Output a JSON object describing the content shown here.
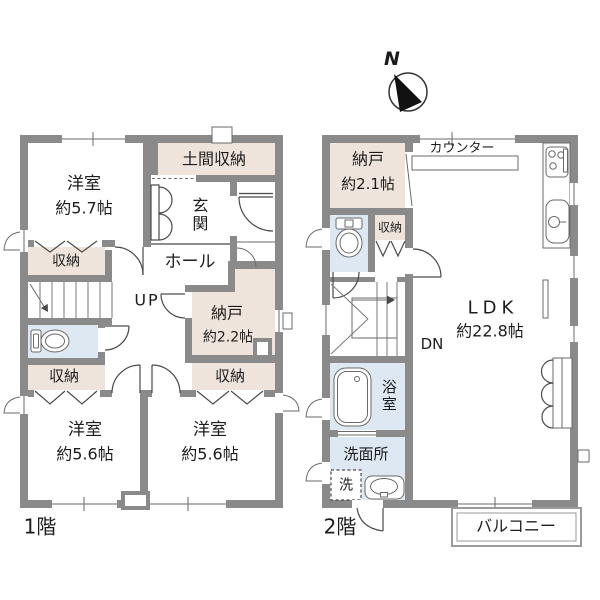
{
  "colors": {
    "wall": "#8a8a8a",
    "storage": "#eee4db",
    "water": "#dde8f3",
    "line": "#4a4a4a",
    "balcony": "#9a9a9a",
    "text": "#1c1c1c"
  },
  "compass": {
    "north": "N"
  },
  "floor1": {
    "label": "1階",
    "bedroom_57": {
      "name": "洋室",
      "size": "約5.7帖"
    },
    "doma_storage": {
      "label": "土間収納"
    },
    "entrance": {
      "label": "玄関"
    },
    "hall": {
      "label": "ホール"
    },
    "stairs": {
      "label": "UP"
    },
    "closet_north": {
      "label": "収納"
    },
    "storage_room": {
      "name": "納戸",
      "size": "約2.2帖"
    },
    "closet_west": {
      "label": "収納"
    },
    "closet_east": {
      "label": "収納"
    },
    "bedroom_56_west": {
      "name": "洋室",
      "size": "約5.6帖"
    },
    "bedroom_56_east": {
      "name": "洋室",
      "size": "約5.6帖"
    }
  },
  "floor2": {
    "label": "2階",
    "storage_room": {
      "name": "納戸",
      "size": "約2.1帖"
    },
    "counter": {
      "label": "カウンター"
    },
    "closet": {
      "label": "収納"
    },
    "stairs": {
      "label": "DN"
    },
    "ldk": {
      "name": "LDK",
      "size": "約22.8帖"
    },
    "bathroom": {
      "label": "浴室"
    },
    "washroom": {
      "label": "洗面所"
    },
    "laundry": {
      "label": "洗"
    },
    "balcony": {
      "label": "バルコニー"
    }
  }
}
